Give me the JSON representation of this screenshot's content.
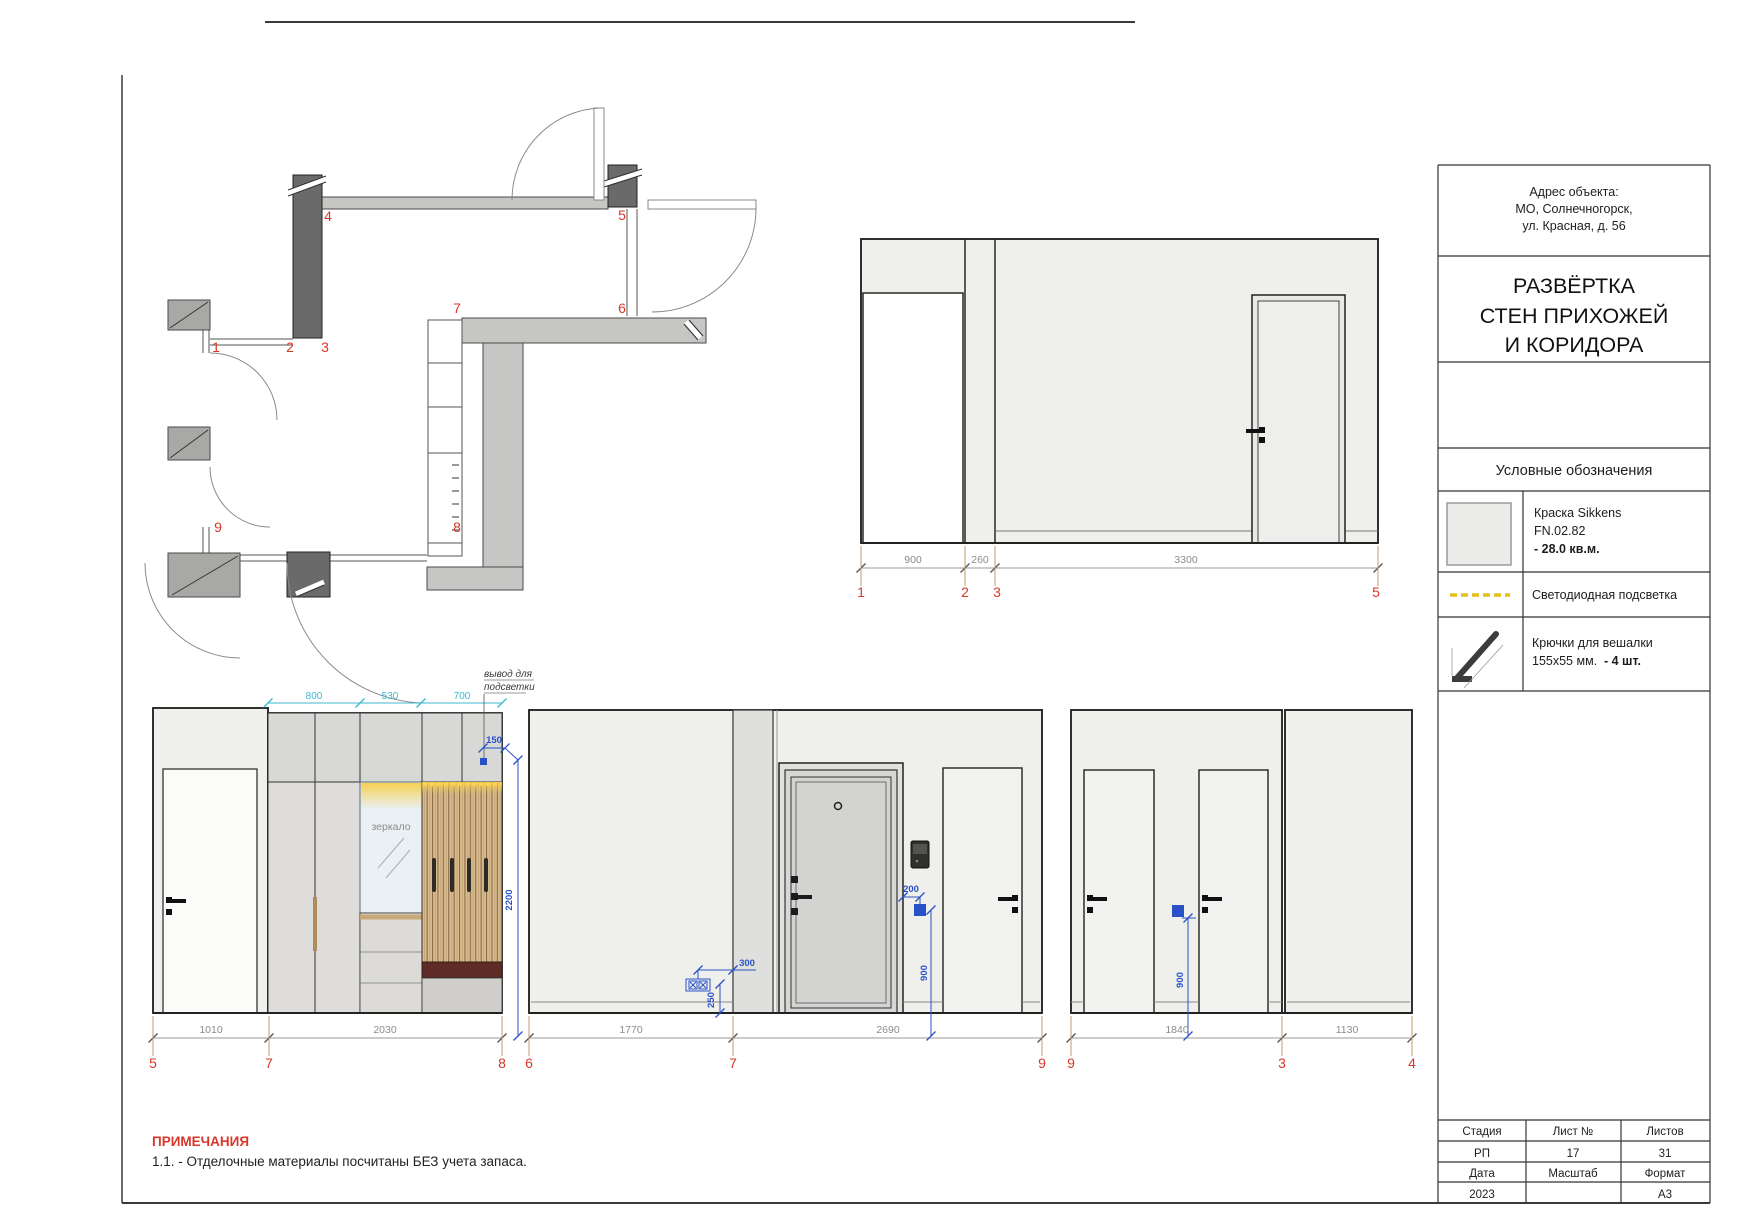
{
  "colors": {
    "marker_red": "#d9372a",
    "dim_gray": "#8c8c8c",
    "extension_orange": "#c49a6c",
    "annotation_blue": "#2952c8",
    "dim_cyan": "#3fb9cf",
    "led_yellow": "#e8be18",
    "wood": "#d8bc90",
    "bench_red": "#5e2b26",
    "wall_fill": "#efefec"
  },
  "title_block": {
    "address": {
      "label": "Адрес объекта:",
      "line1": "МО, Солнечногорск,",
      "line2": "ул. Красная, д. 56"
    },
    "title": {
      "line1": "РАЗВЁРТКА",
      "line2": "СТЕН ПРИХОЖЕЙ",
      "line3": "И КОРИДОРА"
    },
    "legend": {
      "header": "Условные обозначения",
      "paint": {
        "line1": "Краска  Sikkens",
        "line2": "FN.02.82",
        "line3": "- 28.0 кв.м."
      },
      "led": {
        "label": "Светодиодная подсветка"
      },
      "hooks": {
        "line1": "Крючки для вешалки",
        "line2": "155х55 мм.",
        "line2_bold": "- 4 шт."
      }
    },
    "stamp": {
      "r1c1": "Стадия",
      "r1c2": "Лист №",
      "r1c3": "Листов",
      "r2c1": "РП",
      "r2c2": "17",
      "r2c3": "31",
      "r3c1": "Дата",
      "r3c2": "Масштаб",
      "r3c3": "Формат",
      "r4c1": "2023",
      "r4c2": "",
      "r4c3": "А3"
    }
  },
  "notes": {
    "header": "ПРИМЕЧАНИЯ",
    "item1": "1.1. - Отделочные материалы посчитаны БЕЗ учета запаса."
  },
  "plan": {
    "m1": "1",
    "m2": "2",
    "m3": "3",
    "m4": "4",
    "m5": "5",
    "m6": "6",
    "m7": "7",
    "m8": "8",
    "m9": "9"
  },
  "elev_hall": {
    "dim1": "900",
    "dim2": "260",
    "dim3": "3300",
    "m1": "1",
    "m2": "2",
    "m3": "3",
    "m5": "5"
  },
  "elev_wardrobe": {
    "top_dim1": "800",
    "top_dim2": "530",
    "top_dim3": "700",
    "dim_150": "150",
    "dim_2200": "2200",
    "mirror_label": "зеркало",
    "callout_line1": "вывод для",
    "callout_line2": "подсветки",
    "bot_dim1": "1010",
    "bot_dim2": "2030",
    "m5": "5",
    "m7": "7",
    "m8": "8"
  },
  "elev_entry": {
    "dim_300": "300",
    "dim_250": "250",
    "dim_200": "200",
    "dim_900": "900",
    "bot_dim1": "1770",
    "bot_dim2": "2690",
    "m6": "6",
    "m7": "7",
    "m9": "9"
  },
  "elev_rooms": {
    "dim_900": "900",
    "bot_dim1": "1840",
    "bot_dim2": "1130",
    "m9": "9",
    "m3": "3",
    "m4": "4"
  }
}
